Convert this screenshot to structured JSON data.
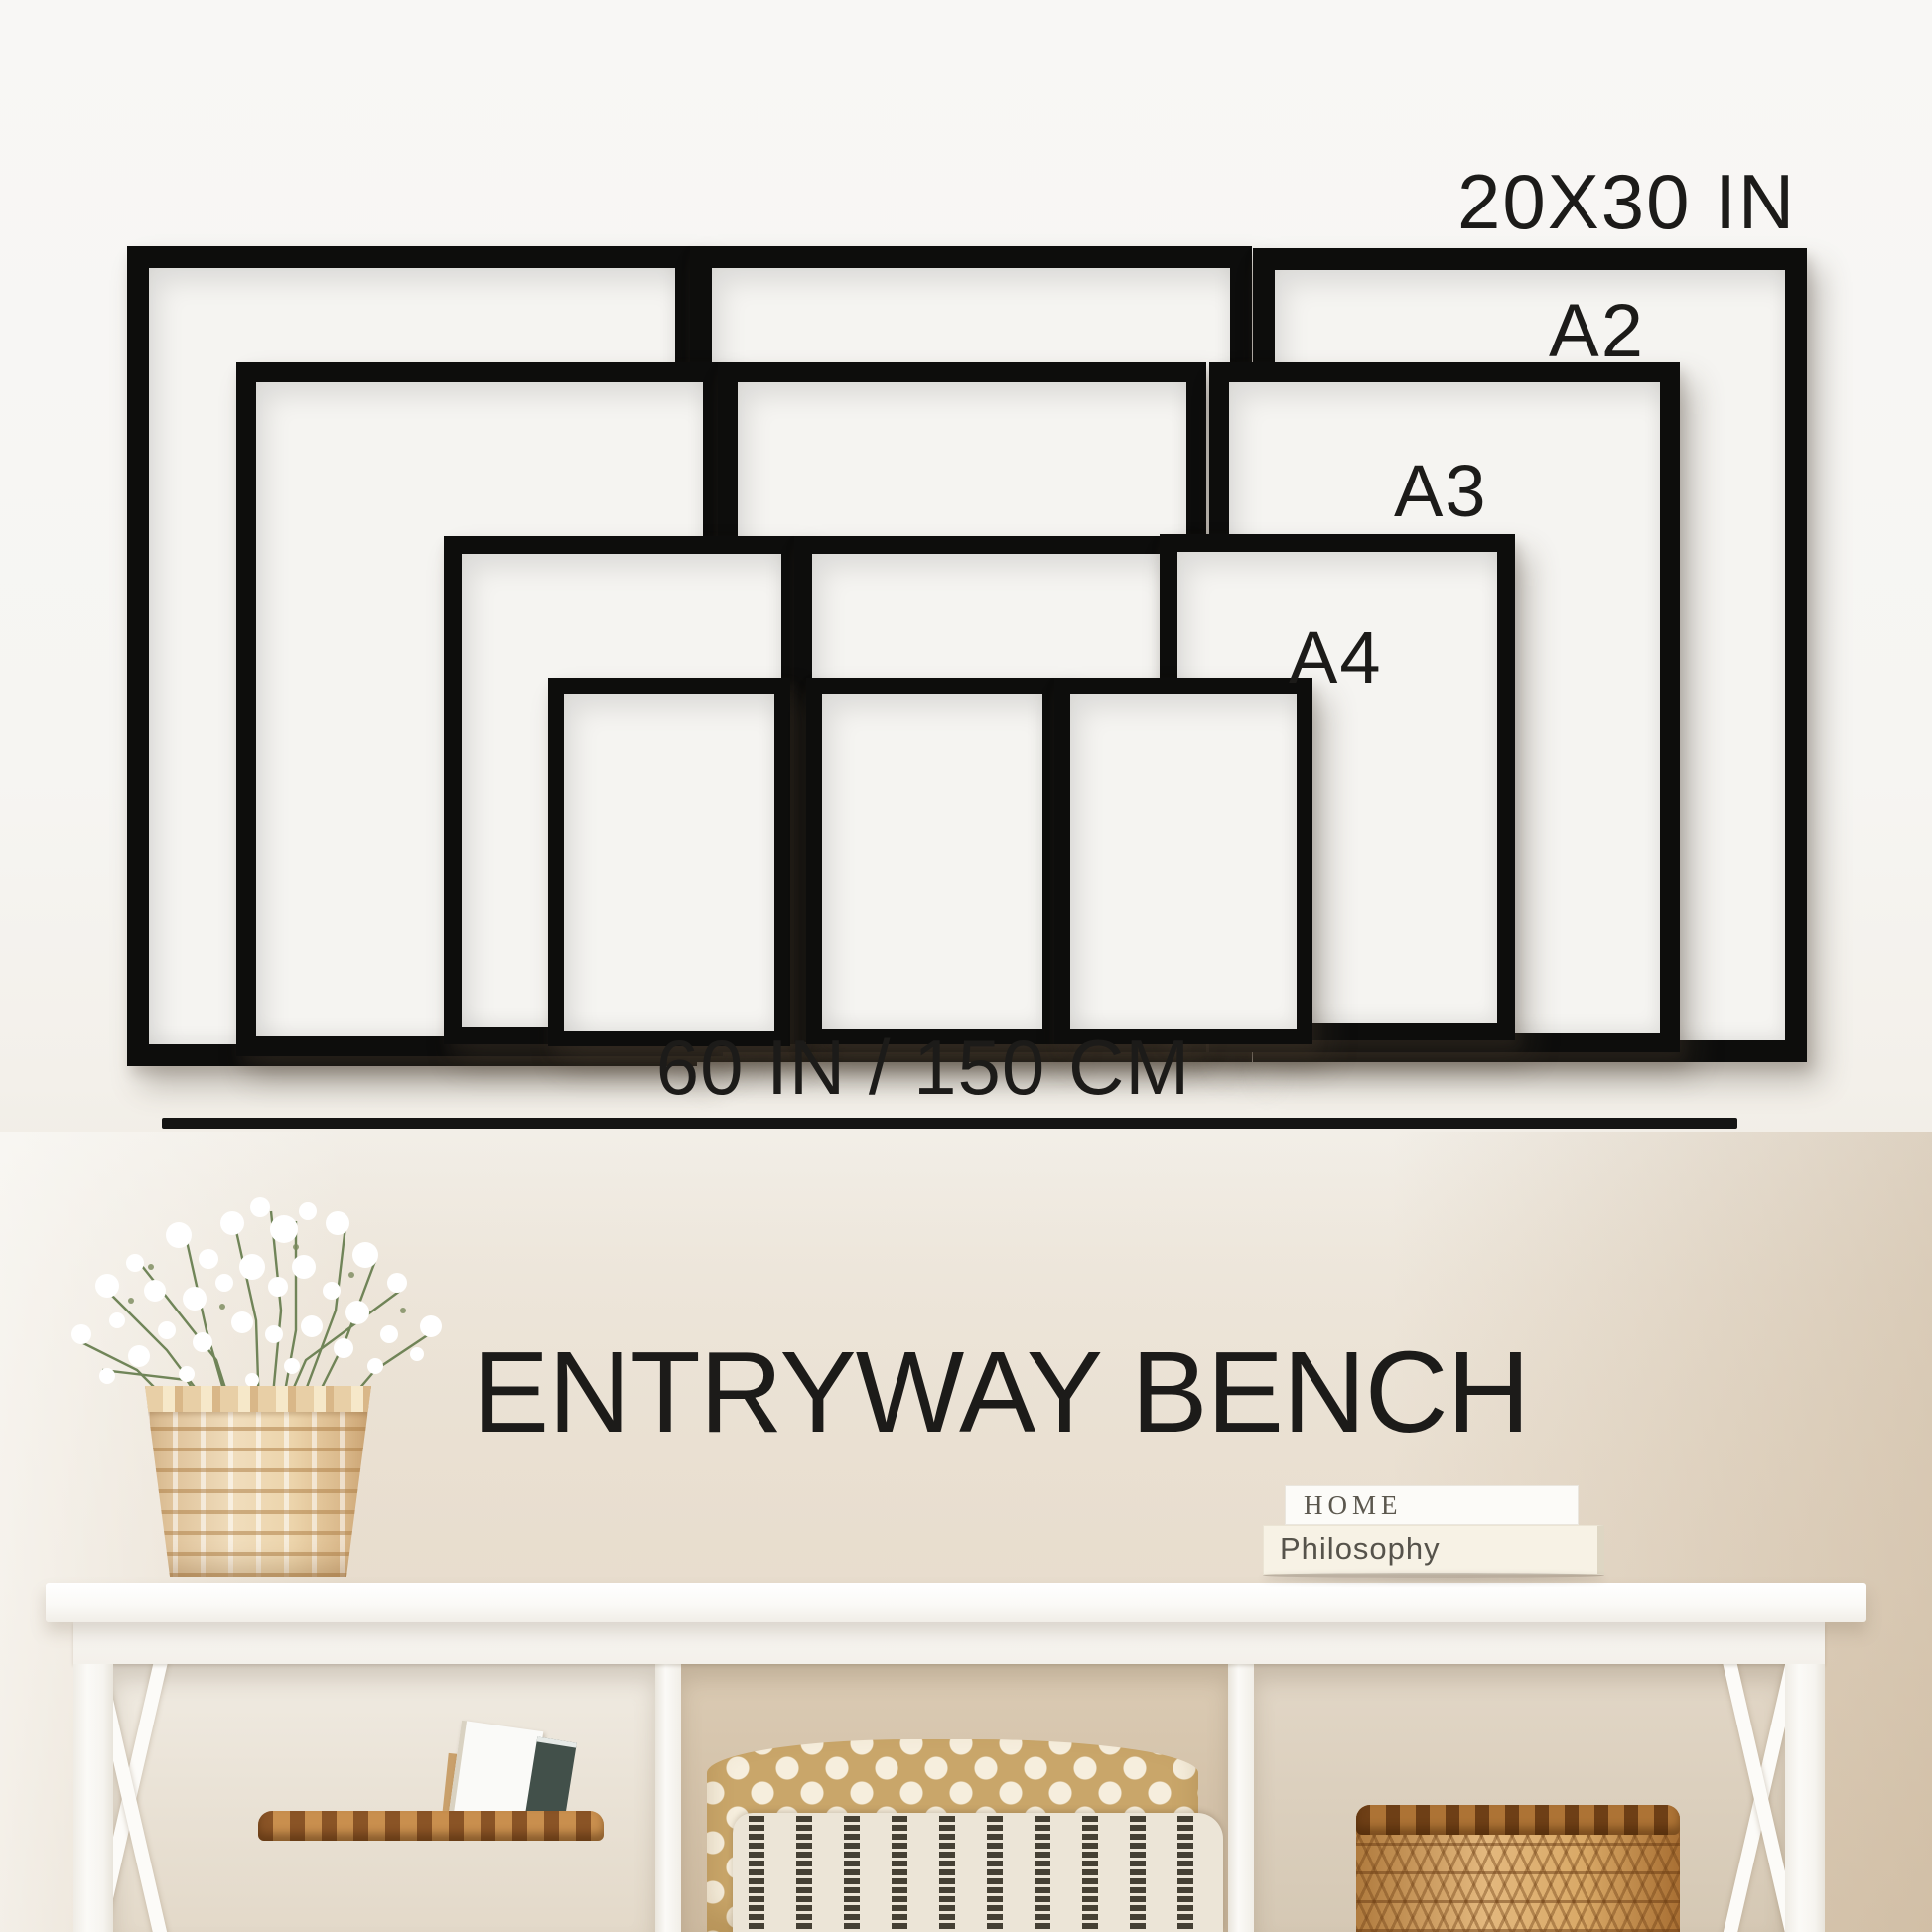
{
  "size_guide": {
    "label_20x30": "20X30 IN",
    "label_a2": "A2",
    "label_a3": "A3",
    "label_a4": "A4",
    "width_caption": "60 IN / 150 CM",
    "frame_sizes": [
      "20X30 IN",
      "A2",
      "A3",
      "A4"
    ],
    "frame_count": 12
  },
  "title": "ENTRYWAY BENCH",
  "books": {
    "top_title": "HOME",
    "bottom_title": "Philosophy"
  },
  "palette": {
    "frame_black": "#0d0d0c",
    "wall_top": "#f7f6f4",
    "wall_bottom": "#e3d7c8",
    "bench_white": "#fbfaf7",
    "cubby_tan": "#cfbda4",
    "basket_light": "#e6c793",
    "basket_dark": "#d8a564",
    "pillow_dot_tan": "#c9a66a",
    "pillow_stripe_cream": "#ece5d7",
    "text_black": "#1c1b19"
  }
}
